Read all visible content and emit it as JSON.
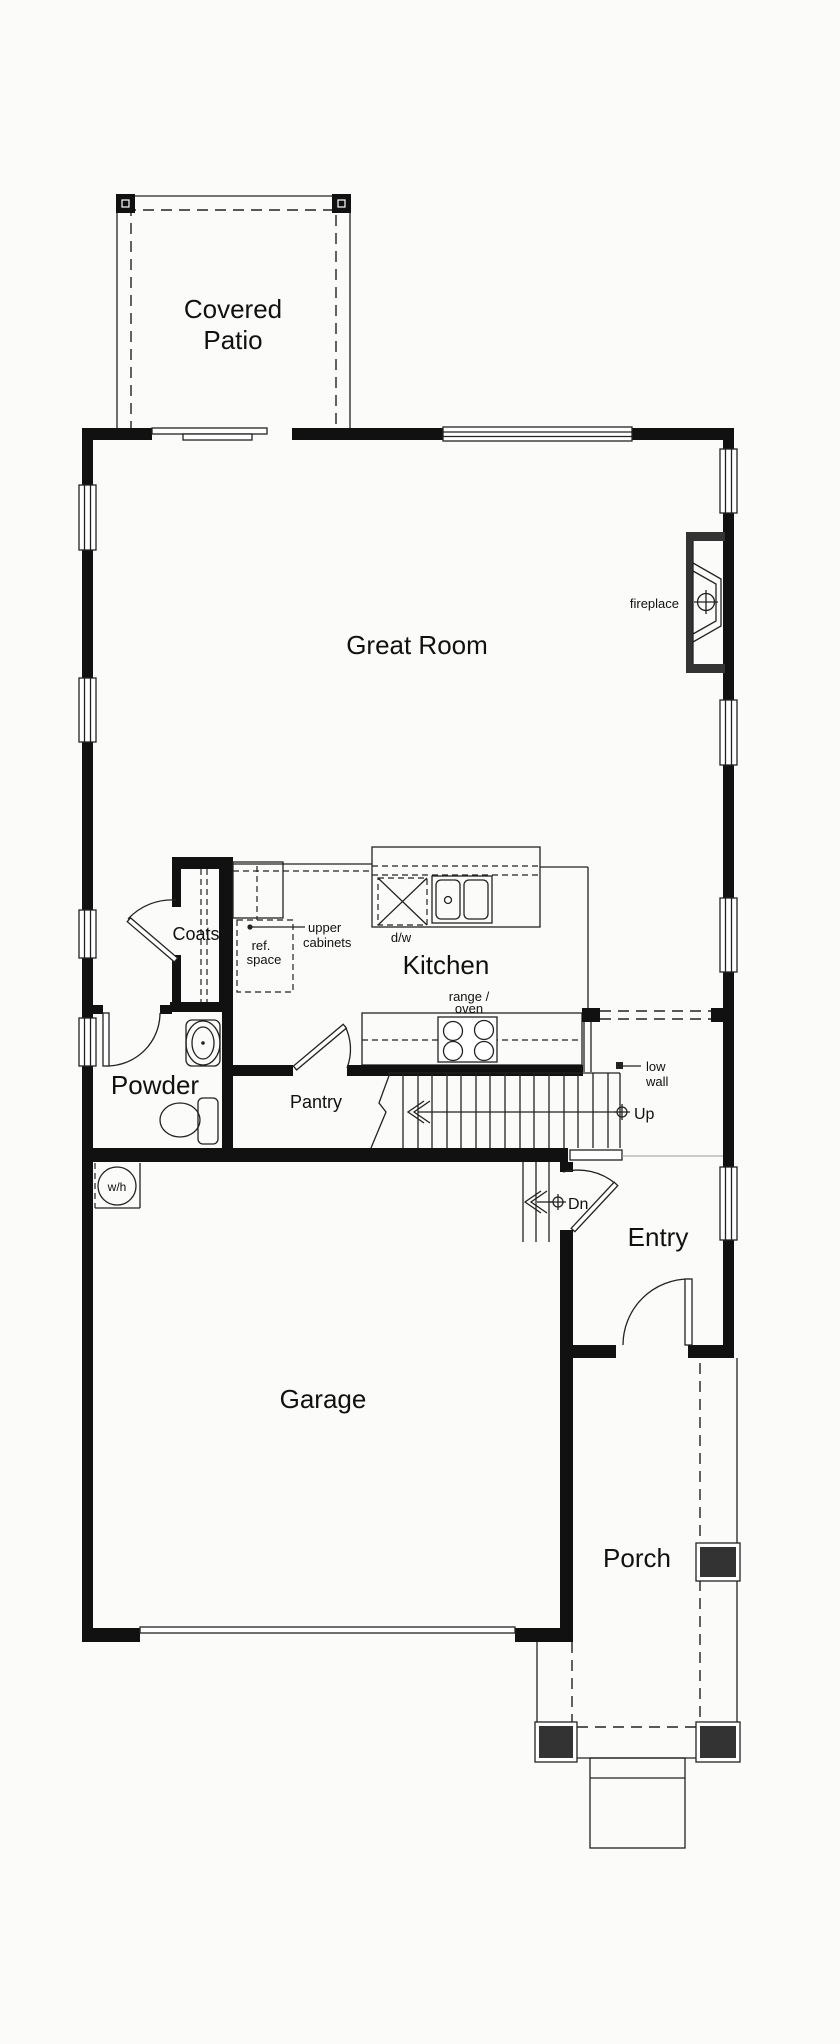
{
  "rooms": {
    "covered_patio": {
      "line1": "Covered",
      "line2": "Patio"
    },
    "great_room": "Great Room",
    "coats": "Coats",
    "kitchen": "Kitchen",
    "pantry": "Pantry",
    "powder": "Powder",
    "entry": "Entry",
    "garage": "Garage",
    "porch": "Porch"
  },
  "annotations": {
    "fireplace": "fireplace",
    "upper_cabinets": {
      "line1": "upper",
      "line2": "cabinets"
    },
    "ref_space": {
      "line1": "ref.",
      "line2": "space"
    },
    "dishwasher": "d/w",
    "range_oven": {
      "line1": "range /",
      "line2": "oven"
    },
    "low_wall": {
      "line1": "low",
      "line2": "wall"
    },
    "up": "Up",
    "down": "Dn",
    "water_heater": "w/h"
  },
  "colors": {
    "wall": "#111111",
    "line": "#222222",
    "post_fill": "#333333",
    "background": "#fbfbf9",
    "text": "#111111"
  }
}
